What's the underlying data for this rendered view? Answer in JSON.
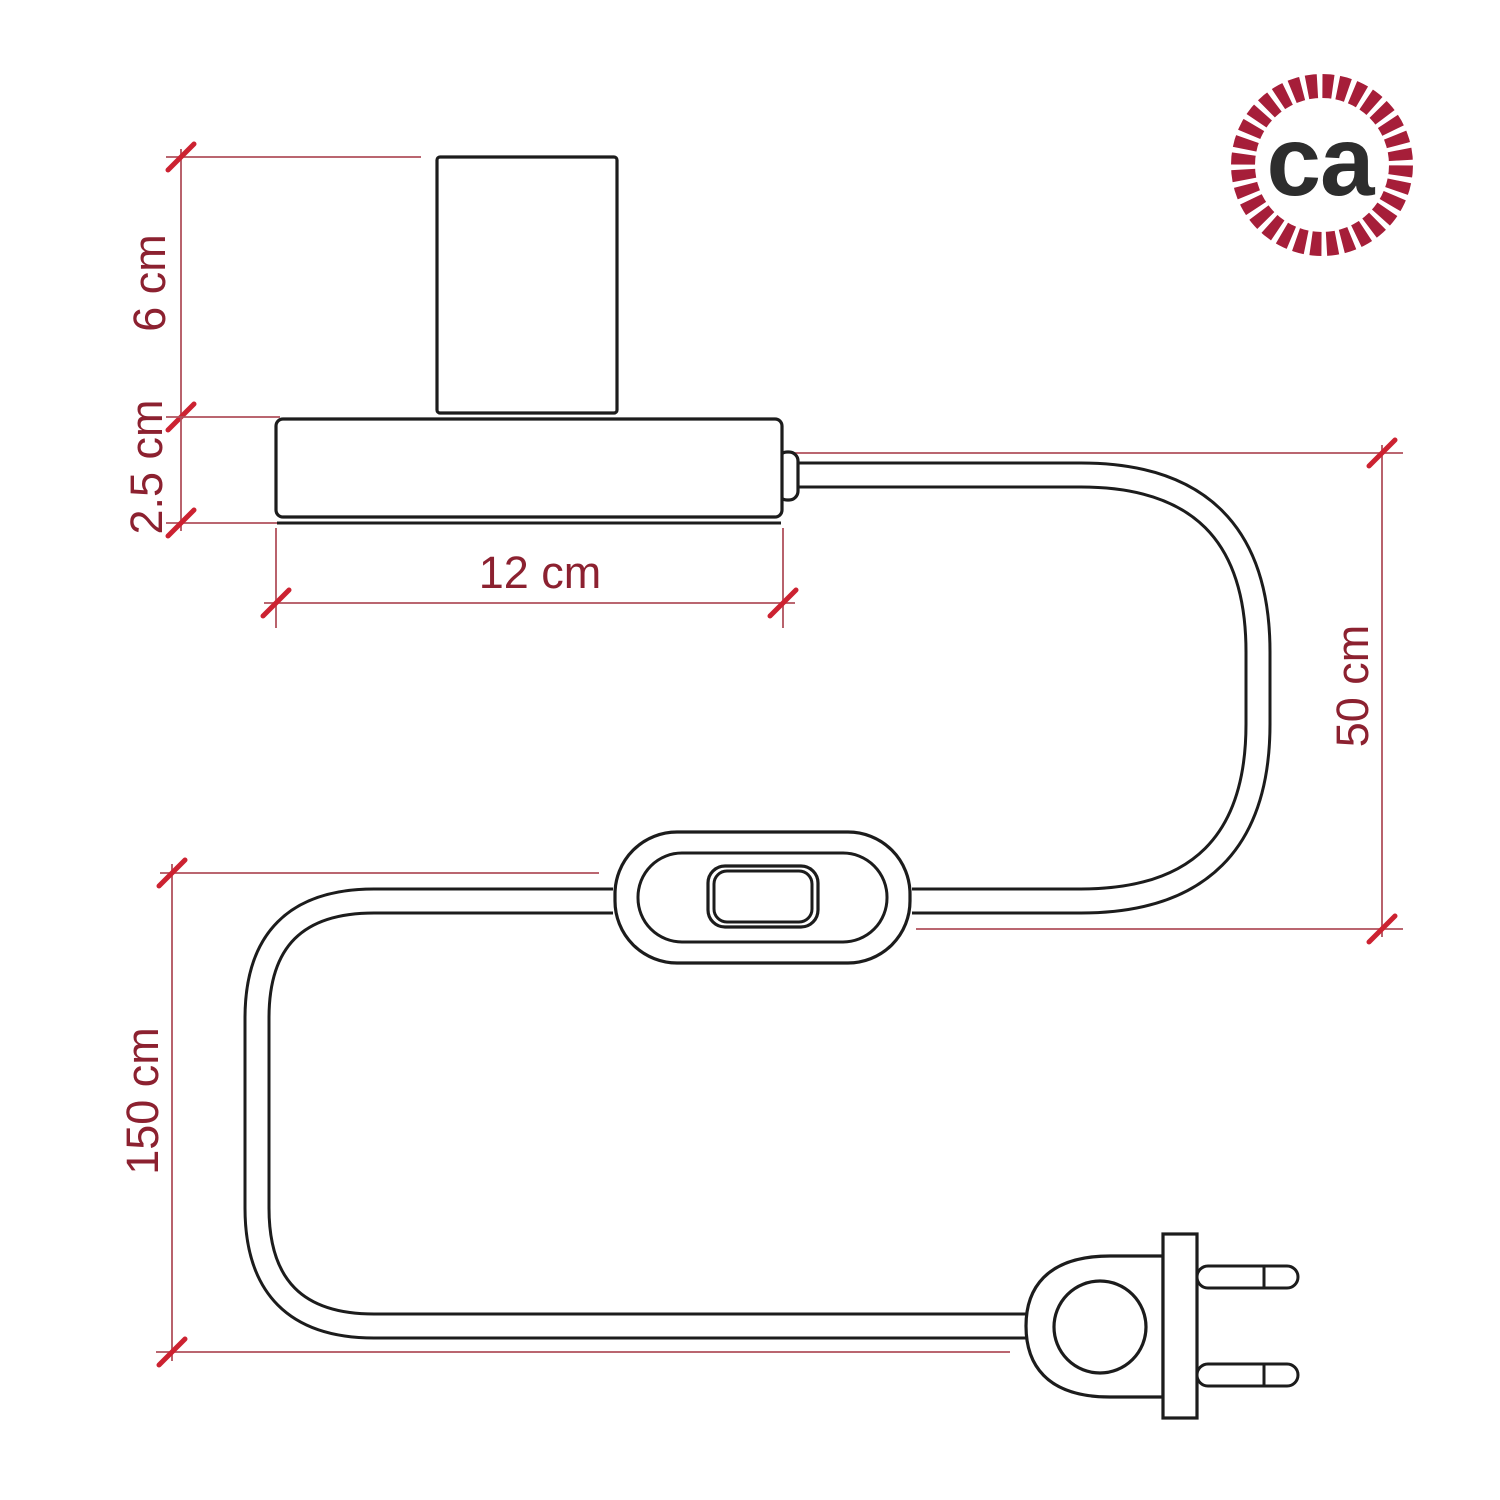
{
  "dims": {
    "socket_height": {
      "label": "6 cm",
      "orientation": "vertical"
    },
    "base_height": {
      "label": "2.5 cm",
      "orientation": "vertical"
    },
    "base_width": {
      "label": "12 cm",
      "orientation": "horizontal"
    },
    "cable_upper_run": {
      "label": "50 cm",
      "orientation": "vertical"
    },
    "cable_lower_run": {
      "label": "150 cm",
      "orientation": "vertical"
    }
  },
  "logo": {
    "text": "ca",
    "icon": "rope-circle-badge",
    "ring_color": "#a61e39",
    "letters_color": "#2d2d2d"
  },
  "style": {
    "paper": "#ffffff",
    "outline": "#1c1c1c",
    "dim_line": "#b1505c",
    "tick": "#cc2231",
    "dim_text": "#8c2130"
  }
}
